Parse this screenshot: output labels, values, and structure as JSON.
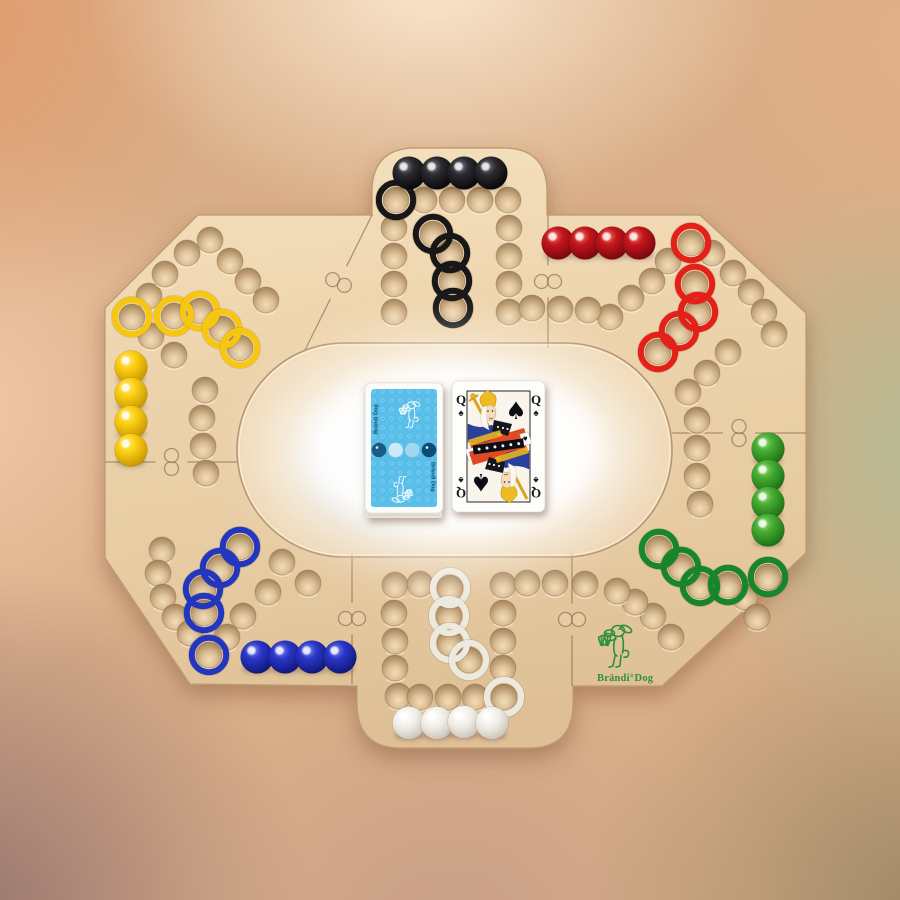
{
  "title": "Brändi Dog wooden board game",
  "colors": {
    "wood": "#ecd2ab",
    "seam": "#75593b",
    "glow": "#ffffff",
    "card_back": "#56bee9",
    "logo_green": "#2e8f3d"
  },
  "board": {
    "players": [
      {
        "name": "black",
        "marble_hex": "#1c1c20",
        "ring_hex": "#171717",
        "marbles": [
          [
            409,
            173
          ],
          [
            437,
            173
          ],
          [
            464,
            173
          ],
          [
            491,
            173
          ]
        ],
        "start": [
          396,
          200
        ],
        "finish": [
          [
            433,
            234
          ],
          [
            450,
            253
          ],
          [
            452,
            281
          ],
          [
            453,
            308
          ]
        ]
      },
      {
        "name": "red",
        "marble_hex": "#c5151d",
        "ring_hex": "#e52018",
        "marbles": [
          [
            558,
            243
          ],
          [
            585,
            243
          ],
          [
            612,
            243
          ],
          [
            639,
            243
          ]
        ],
        "start": [
          691,
          243
        ],
        "finish": [
          [
            695,
            284
          ],
          [
            698,
            312
          ],
          [
            679,
            331
          ],
          [
            658,
            352
          ]
        ]
      },
      {
        "name": "green",
        "marble_hex": "#46ad33",
        "ring_hex": "#17862a",
        "marbles": [
          [
            768,
            449
          ],
          [
            768,
            476
          ],
          [
            768,
            503
          ],
          [
            768,
            530
          ]
        ],
        "start": [
          768,
          577
        ],
        "finish": [
          [
            728,
            585
          ],
          [
            700,
            586
          ],
          [
            681,
            567
          ],
          [
            659,
            549
          ]
        ]
      },
      {
        "name": "white",
        "marble_hex": "#f3efe7",
        "ring_hex": "#eceadf",
        "marbles": [
          [
            409,
            723
          ],
          [
            437,
            723
          ],
          [
            464,
            722
          ],
          [
            492,
            723
          ]
        ],
        "start": [
          504,
          697
        ],
        "finish": [
          [
            450,
            588
          ],
          [
            449,
            616
          ],
          [
            450,
            643
          ],
          [
            469,
            660
          ]
        ]
      },
      {
        "name": "blue",
        "marble_hex": "#2a36c9",
        "ring_hex": "#2336c0",
        "marbles": [
          [
            257,
            657
          ],
          [
            285,
            657
          ],
          [
            312,
            657
          ],
          [
            340,
            657
          ]
        ],
        "start": [
          209,
          655
        ],
        "finish": [
          [
            240,
            547
          ],
          [
            220,
            568
          ],
          [
            203,
            589
          ],
          [
            204,
            613
          ]
        ]
      },
      {
        "name": "yellow",
        "marble_hex": "#fdd015",
        "ring_hex": "#f6c70e",
        "marbles": [
          [
            131,
            367
          ],
          [
            131,
            394
          ],
          [
            131,
            422
          ],
          [
            131,
            450
          ]
        ],
        "start": [
          132,
          317
        ],
        "finish": [
          [
            174,
            316
          ],
          [
            200,
            311
          ],
          [
            222,
            329
          ],
          [
            240,
            348
          ]
        ]
      }
    ],
    "holes": [
      [
        424,
        200
      ],
      [
        452,
        200
      ],
      [
        480,
        200
      ],
      [
        508,
        200
      ],
      [
        394,
        228
      ],
      [
        394,
        256
      ],
      [
        394,
        284
      ],
      [
        394,
        312
      ],
      [
        509,
        228
      ],
      [
        509,
        256
      ],
      [
        509,
        284
      ],
      [
        509,
        312
      ],
      [
        668,
        261
      ],
      [
        652,
        281
      ],
      [
        631,
        298
      ],
      [
        610,
        317
      ],
      [
        588,
        310
      ],
      [
        560,
        309
      ],
      [
        532,
        308
      ],
      [
        712,
        253
      ],
      [
        733,
        273
      ],
      [
        751,
        292
      ],
      [
        764,
        312
      ],
      [
        774,
        334
      ],
      [
        728,
        352
      ],
      [
        707,
        373
      ],
      [
        688,
        392
      ],
      [
        697,
        420
      ],
      [
        697,
        448
      ],
      [
        697,
        476
      ],
      [
        700,
        504
      ],
      [
        745,
        597
      ],
      [
        757,
        617
      ],
      [
        671,
        637
      ],
      [
        653,
        616
      ],
      [
        635,
        602
      ],
      [
        617,
        591
      ],
      [
        585,
        584
      ],
      [
        395,
        585
      ],
      [
        394,
        613
      ],
      [
        395,
        641
      ],
      [
        395,
        668
      ],
      [
        398,
        696
      ],
      [
        420,
        697
      ],
      [
        448,
        697
      ],
      [
        475,
        697
      ],
      [
        503,
        585
      ],
      [
        503,
        613
      ],
      [
        503,
        641
      ],
      [
        503,
        668
      ],
      [
        420,
        584
      ],
      [
        527,
        583
      ],
      [
        555,
        583
      ],
      [
        162,
        550
      ],
      [
        158,
        573
      ],
      [
        163,
        597
      ],
      [
        175,
        617
      ],
      [
        190,
        633
      ],
      [
        268,
        592
      ],
      [
        243,
        616
      ],
      [
        227,
        637
      ],
      [
        282,
        562
      ],
      [
        308,
        583
      ],
      [
        149,
        296
      ],
      [
        165,
        274
      ],
      [
        187,
        253
      ],
      [
        210,
        240
      ],
      [
        230,
        261
      ],
      [
        248,
        281
      ],
      [
        266,
        300
      ],
      [
        151,
        336
      ],
      [
        174,
        355
      ],
      [
        205,
        390
      ],
      [
        202,
        418
      ],
      [
        203,
        446
      ],
      [
        206,
        473
      ]
    ],
    "seams": [
      [
        372,
        215,
        305,
        350
      ],
      [
        548,
        215,
        548,
        348
      ],
      [
        672,
        433,
        806,
        433
      ],
      [
        572,
        553,
        572,
        686
      ],
      [
        352,
        553,
        352,
        684
      ],
      [
        105,
        462,
        238,
        462
      ]
    ]
  },
  "cards": {
    "deck_label": "Brändi Dog",
    "face": {
      "rank": "Q",
      "suit": "♠"
    }
  },
  "logo": {
    "brand": "Brändi",
    "reg": "®",
    "product": "Dog"
  }
}
